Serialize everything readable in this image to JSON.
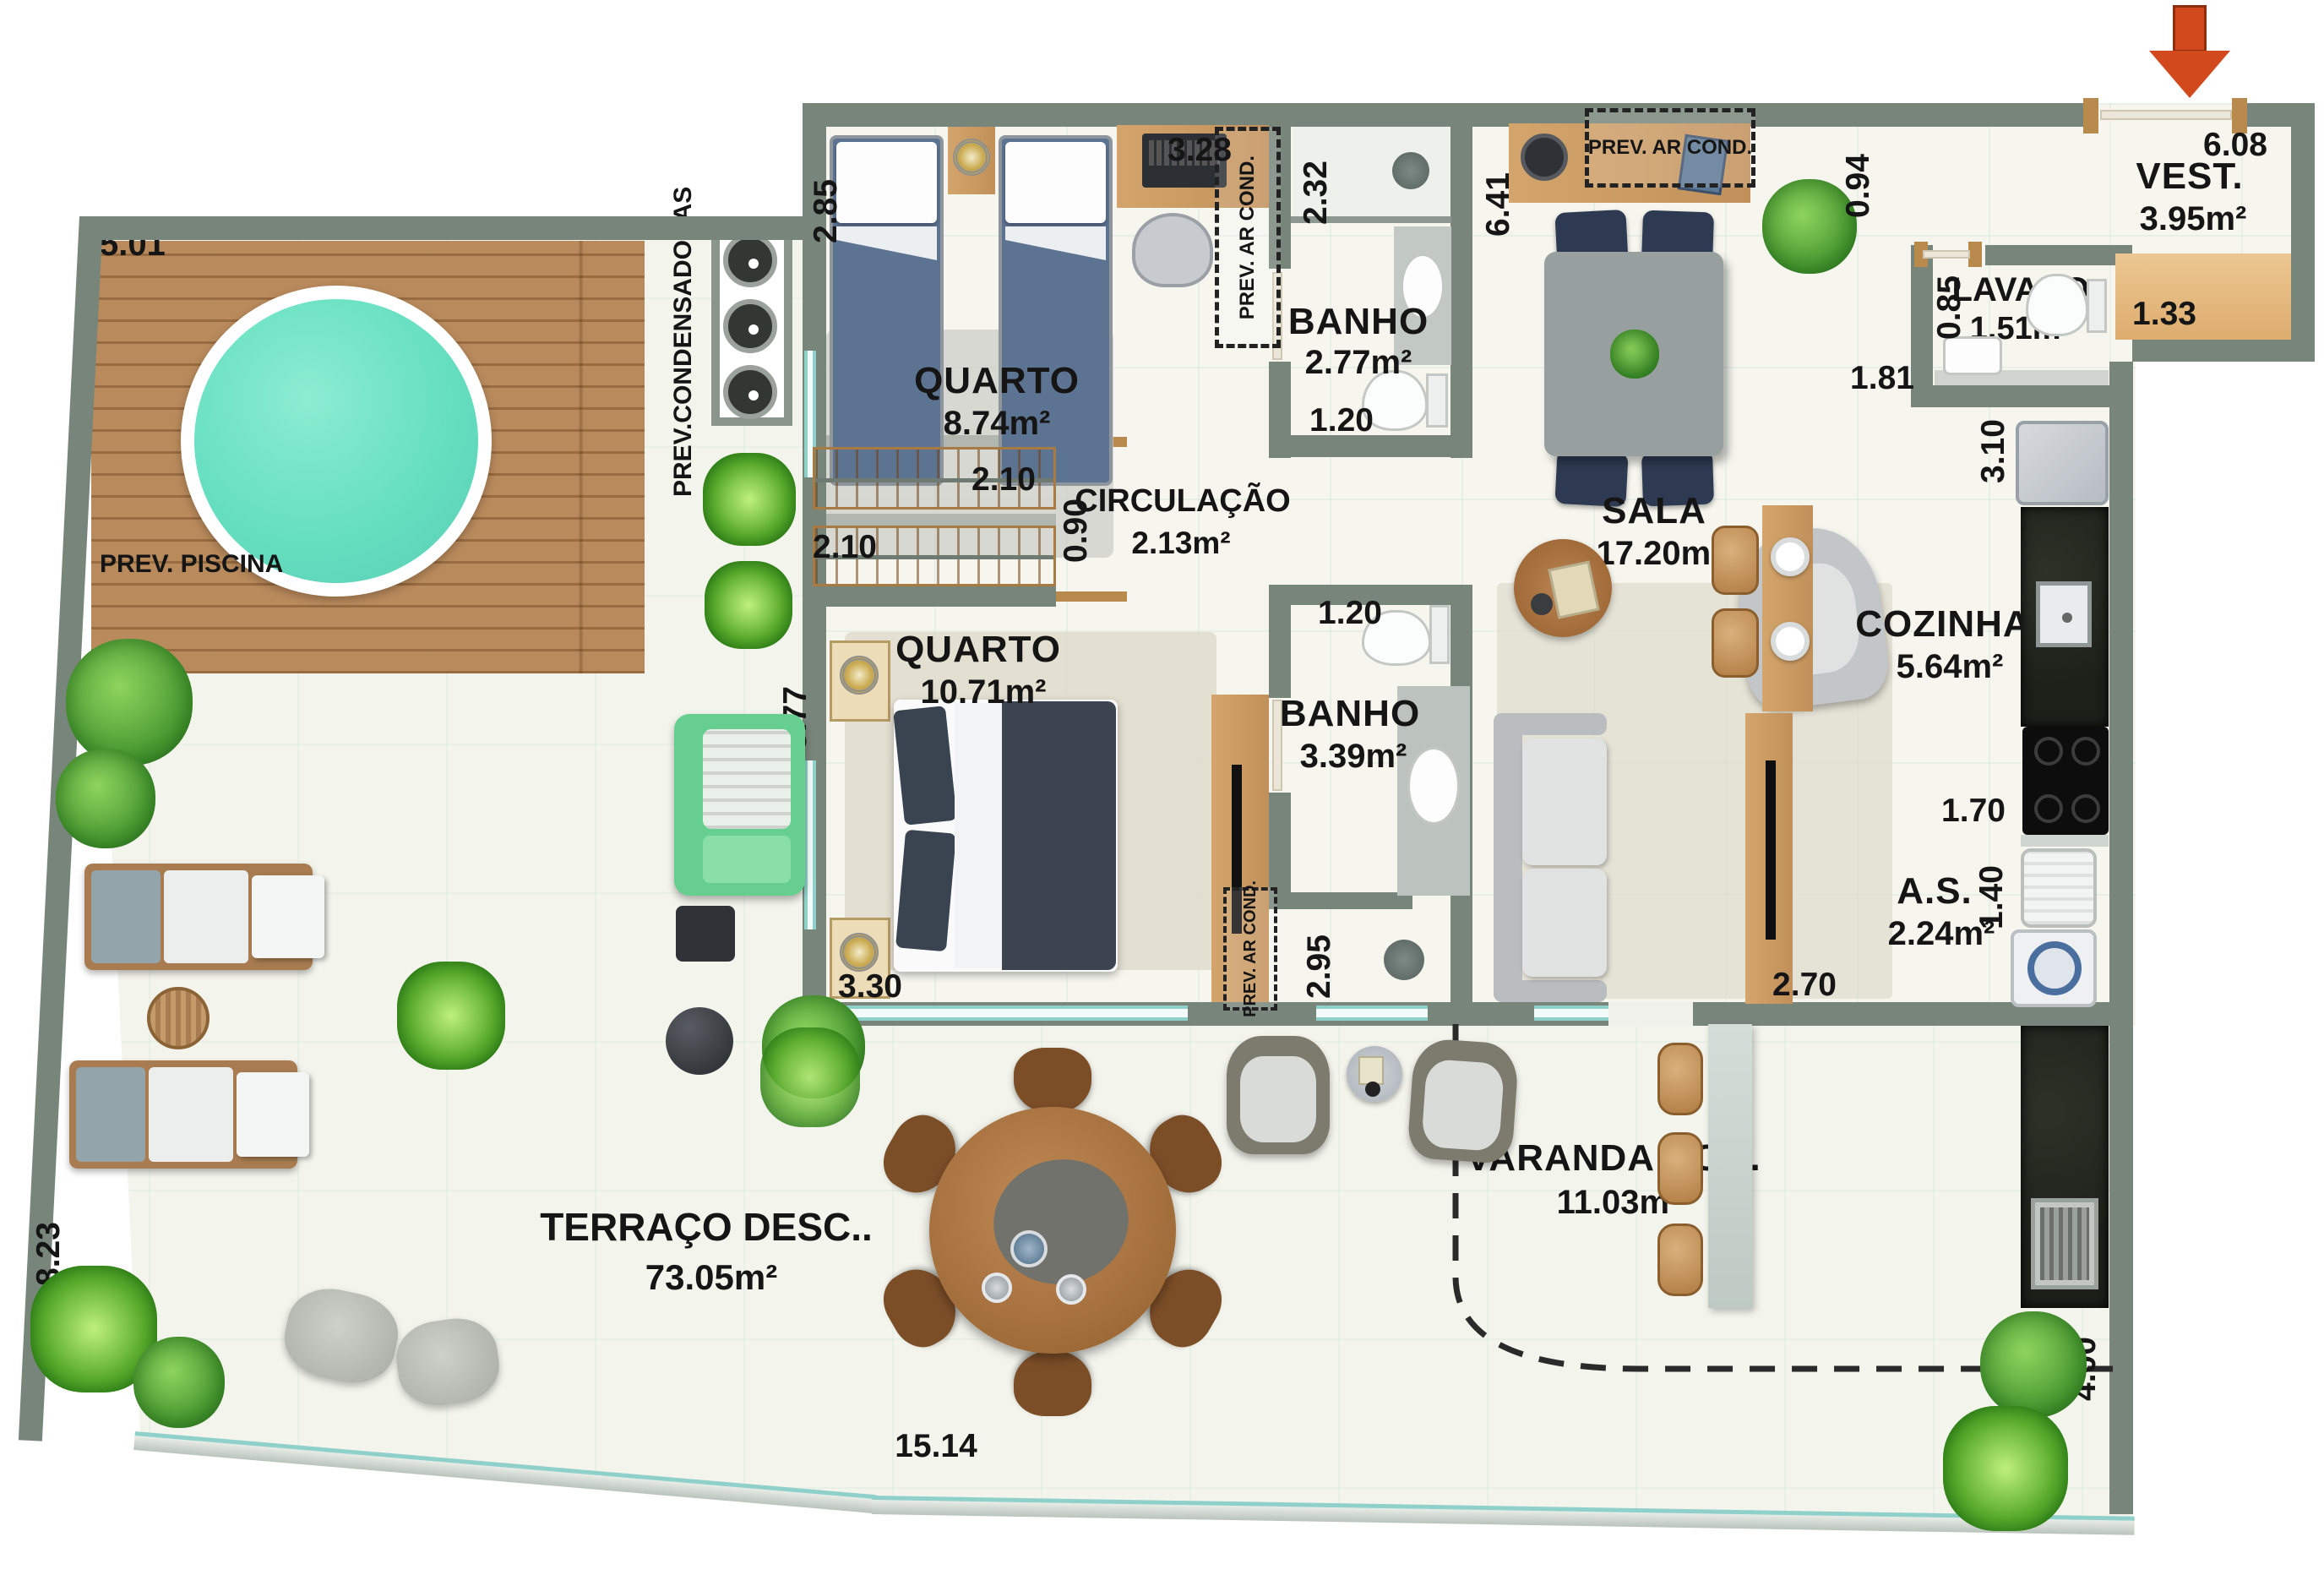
{
  "rooms": {
    "quarto1": {
      "name": "QUARTO",
      "area": "8.74m²"
    },
    "banho1": {
      "name": "BANHO",
      "area": "2.77m²"
    },
    "circulacao": {
      "name": "CIRCULAÇÃO",
      "area": "2.13m²"
    },
    "quarto2": {
      "name": "QUARTO",
      "area": "10.71m²"
    },
    "banho2": {
      "name": "BANHO",
      "area": "3.39m²"
    },
    "sala": {
      "name": "SALA",
      "area": "17.20m²"
    },
    "cozinha": {
      "name": "COZINHA",
      "area": "5.64m²"
    },
    "lavabo": {
      "name": "LAVABO",
      "area": "1.51m²"
    },
    "vest": {
      "name": "VEST.",
      "area": "3.95m²"
    },
    "area_servico": {
      "name": "A.S.",
      "area": "2.24m²"
    },
    "varanda": {
      "name": "VARANDA COB.",
      "area": "11.03m²"
    },
    "terraco": {
      "name": "TERRAÇO DESC..",
      "area": "73.05m²"
    }
  },
  "dims": {
    "deck_top": "5.01",
    "terraco_left": "8.23",
    "terraco_bottom": "15.14",
    "terraco_right": "4.00",
    "quarto1_width": "2.85",
    "quarto1_top": "3.28",
    "banho1_side": "2.32",
    "banho1_bottom": "1.20",
    "closet_sup": "2.10",
    "closet_inf": "2.10",
    "circulacao_width": "0.90",
    "sala_left": "6.41",
    "sala_top": "0.94",
    "vest_top": "6.08",
    "vest_guardaroupa": "1.33",
    "lavabo_width": "0.85",
    "lavabo_length": "1.81",
    "cozinha_side": "3.10",
    "cozinha_bottom": "1.70",
    "as_side": "1.40",
    "tv_base": "2.70",
    "quarto2_left": "5.77",
    "quarto2_bottom": "3.30",
    "banho2_top": "1.20",
    "banho2_side": "2.95"
  },
  "notes": {
    "prev_piscina": "PREV. PISCINA",
    "prev_condensadoras": "PREV.CONDENSADORAS",
    "prev_ar_cond_quarto1": "PREV. AR COND.",
    "prev_ar_cond_sala": "PREV. AR COND.",
    "prev_ar_cond_quarto2": "PREV. AR COND."
  },
  "colors": {
    "wall": "#78857b",
    "wood": "#c89a64",
    "deck": "#b98a5c",
    "pool": "#66dfc0",
    "granite": "#23261f",
    "navy_chair": "#2e3a52",
    "sofa_green": "#6fd393",
    "entry_arrow": "#d2491d",
    "glass": "#8fd0ca"
  }
}
